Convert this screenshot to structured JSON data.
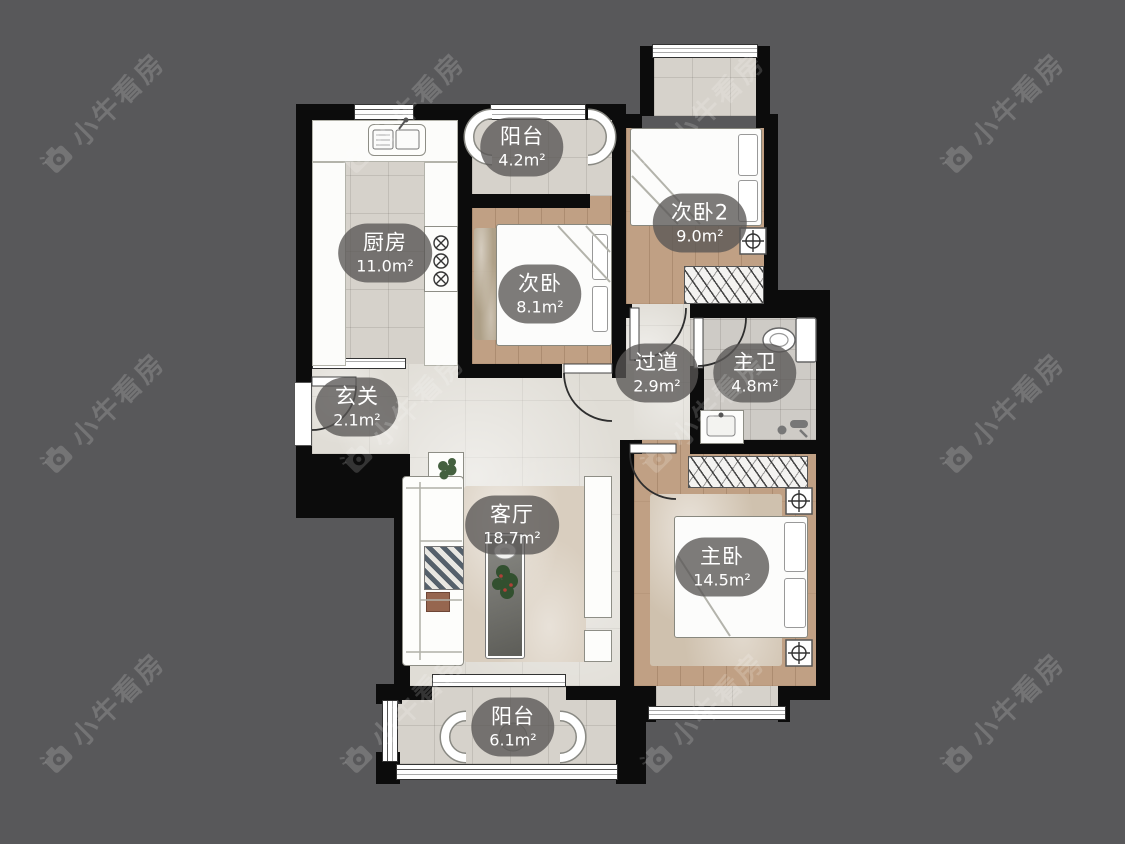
{
  "watermark": {
    "text": "小牛看房"
  },
  "rooms": [
    {
      "id": "balcony-top",
      "name": "阳台",
      "area": "4.2m²"
    },
    {
      "id": "bedroom2-2",
      "name": "次卧2",
      "area": "9.0m²"
    },
    {
      "id": "kitchen",
      "name": "厨房",
      "area": "11.0m²"
    },
    {
      "id": "bedroom2",
      "name": "次卧",
      "area": "8.1m²"
    },
    {
      "id": "corridor",
      "name": "过道",
      "area": "2.9m²"
    },
    {
      "id": "master-bath",
      "name": "主卫",
      "area": "4.8m²"
    },
    {
      "id": "entry",
      "name": "玄关",
      "area": "2.1m²"
    },
    {
      "id": "living-room",
      "name": "客厅",
      "area": "18.7m²"
    },
    {
      "id": "master-bedroom",
      "name": "主卧",
      "area": "14.5m²"
    },
    {
      "id": "balcony-bottom",
      "name": "阳台",
      "area": "6.1m²"
    }
  ]
}
